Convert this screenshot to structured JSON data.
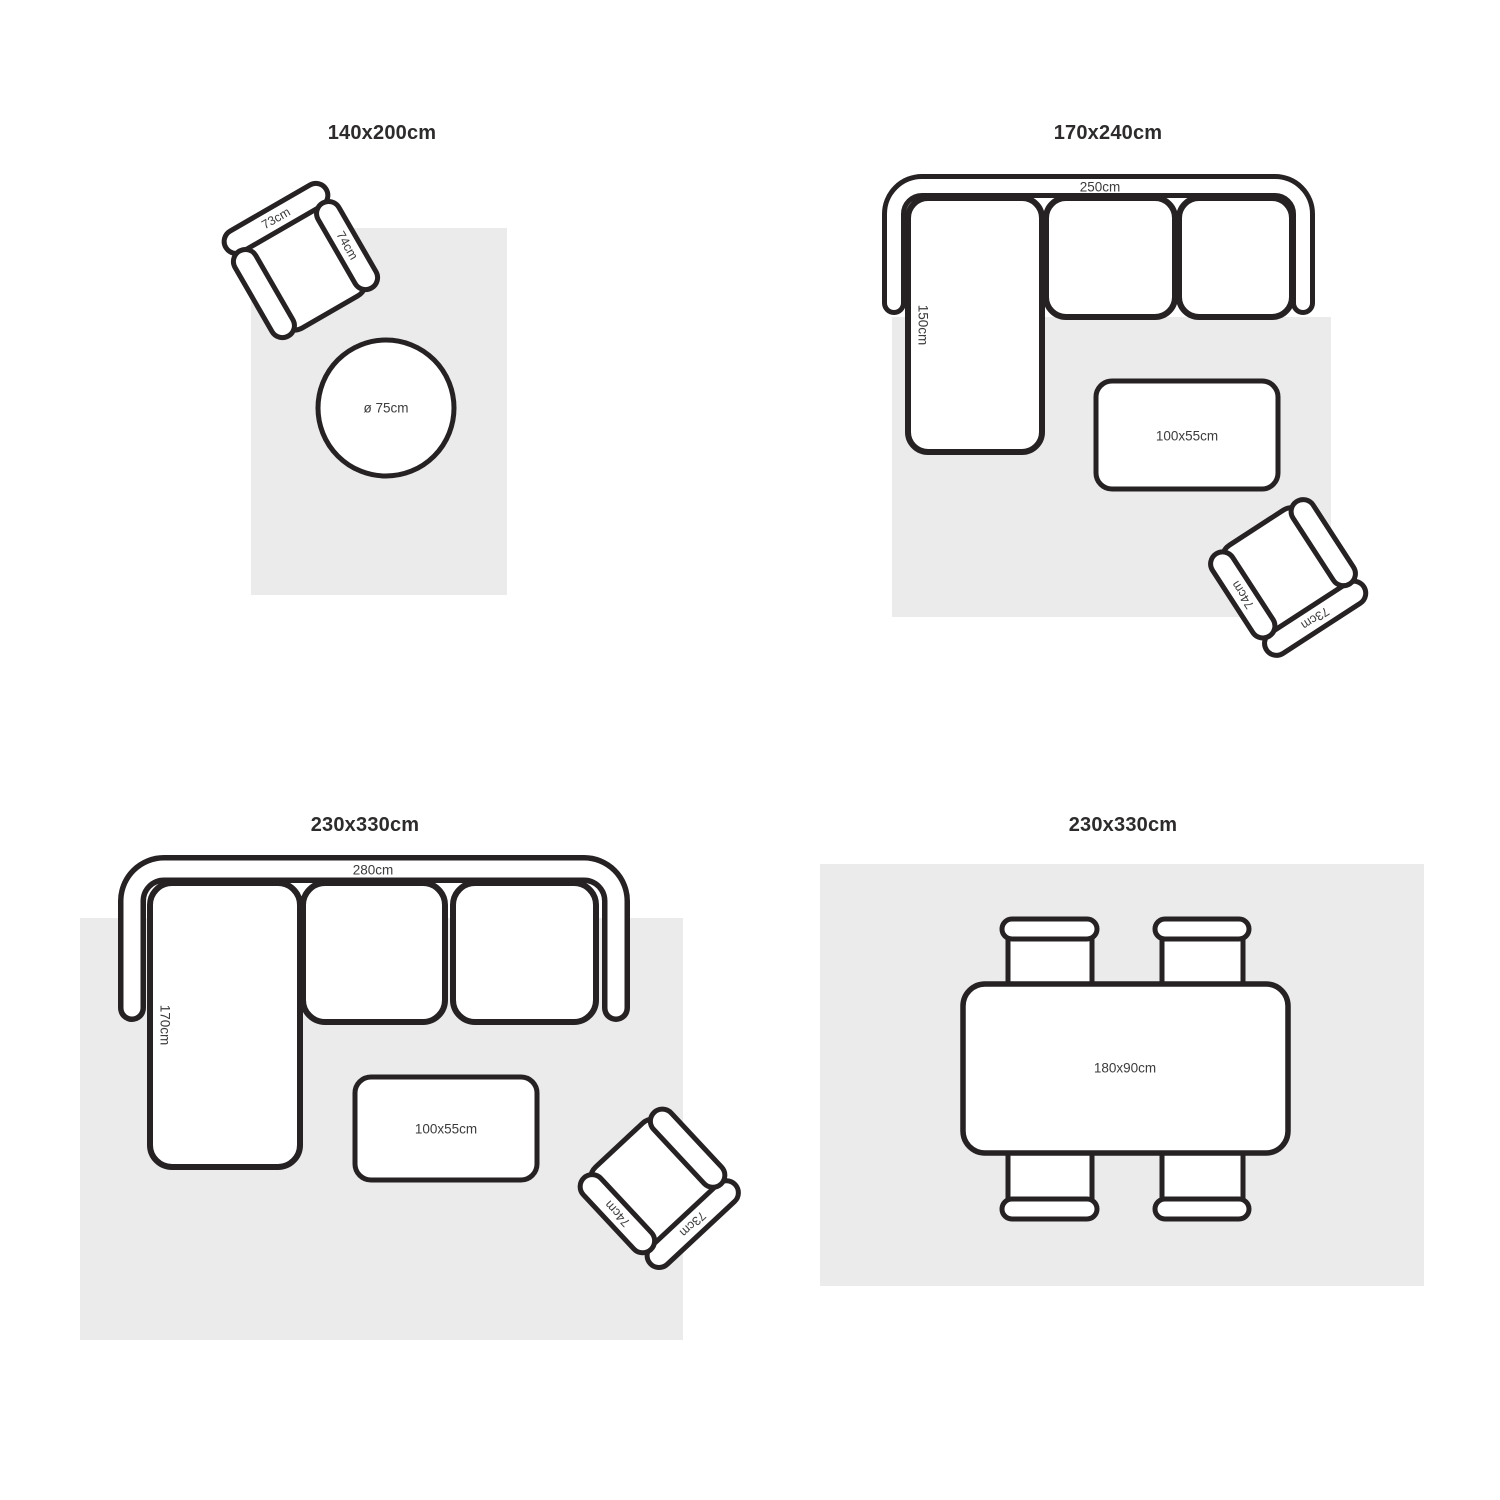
{
  "theme": {
    "outline_color": "#262122",
    "rug_fill": "#ebebeb",
    "title_color": "#2d2b2c",
    "label_color": "#3d3b3c",
    "background": "#ffffff"
  },
  "quadrants": [
    {
      "title": "140x200cm",
      "round_table_label": "ø 75cm",
      "armchair": {
        "back_label": "73cm",
        "side_label": "74cm"
      }
    },
    {
      "title": "170x240cm",
      "sofa": {
        "width_label": "250cm",
        "depth_label": "150cm"
      },
      "coffee_table_label": "100x55cm",
      "armchair": {
        "back_label": "73cm",
        "side_label": "74cm"
      }
    },
    {
      "title": "230x330cm",
      "sofa": {
        "width_label": "280cm",
        "depth_label": "170cm"
      },
      "coffee_table_label": "100x55cm",
      "armchair": {
        "back_label": "73cm",
        "side_label": "74cm"
      }
    },
    {
      "title": "230x330cm",
      "dining_table_label": "180x90cm"
    }
  ]
}
